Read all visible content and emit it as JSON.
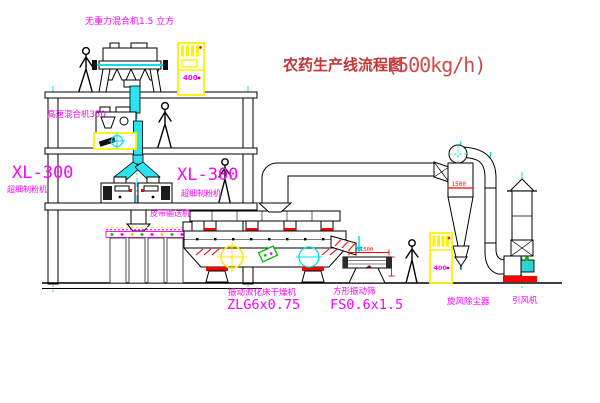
{
  "diagram": {
    "title": {
      "name_cn": "农药生产线流程图",
      "capacity": "(500kg/h)"
    },
    "equipment_labels": {
      "gravity_mixer": "无重力混合机1.5 立方",
      "high_speed_mixer": "高速混合机350",
      "mill_left_model": "XL-300",
      "mill_left_name": "超细制粉机",
      "mill_right_model": "XL-300",
      "mill_right_name": "超细制粉机",
      "belt_conveyor": "皮带输送机",
      "fluid_bed_dryer_name": "振动流化床干燥机",
      "fluid_bed_dryer_model": "ZLG6x0.75",
      "vibrating_screen_name": "方形振动筛",
      "vibrating_screen_model": "FS0.6x1.5",
      "cyclone_name": "旋风除尘器",
      "induced_draft_fan": "引风机"
    },
    "dimensions": {
      "cyclone_dia": "1500",
      "screen_length": "1500"
    },
    "control_cabinet_text": "400",
    "colors": {
      "label_magenta": "#FF00FF",
      "title_red": "#C33636",
      "dimension_red": "#FF0000",
      "centerline_cyan": "#00E0EE",
      "highlight_yellow": "#FFF200",
      "duct_cyan_fill": "#2BE4EF",
      "green_accent": "#00BB00",
      "background": "#FFFFFF"
    }
  }
}
